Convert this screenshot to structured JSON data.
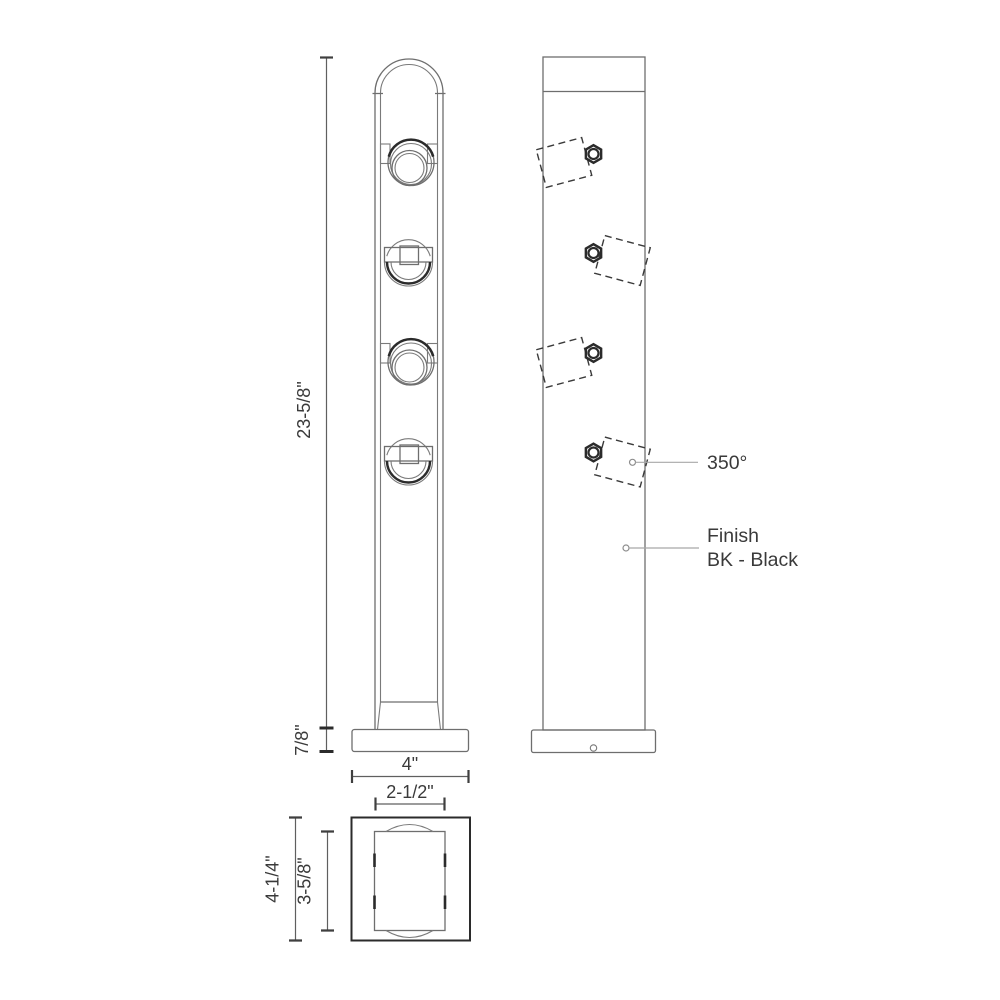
{
  "colors": {
    "line": "#6e6e6e",
    "dark": "#2b2b2b",
    "text": "#3a3a3a",
    "leader": "#a8a8a8",
    "background": "#ffffff"
  },
  "dimensions": {
    "overall_height": "23-5/8\"",
    "base_height": "7/8\"",
    "base_width": "4\"",
    "body_width": "2-1/2\"",
    "base_depth": "4-1/4\"",
    "body_depth": "3-5/8\""
  },
  "callouts": {
    "rotation": "350°",
    "finish_line1": "Finish",
    "finish_line2": "BK - Black"
  }
}
